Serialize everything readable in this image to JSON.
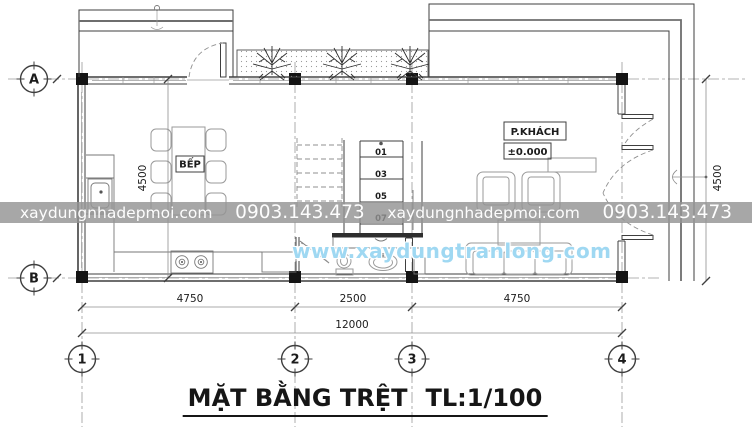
{
  "title": {
    "name": "MẶT BẰNG TRỆT",
    "scale": "TL:1/100"
  },
  "watermarks": {
    "band": {
      "site1": "xaydungnhadepmoi.com",
      "phone1": "0903.143.473",
      "site2": "xaydungnhadepmoi.com",
      "phone2": "0903.143.473"
    },
    "center": "www.xaydungtranlong.com"
  },
  "axes": {
    "a": "A",
    "b": "B",
    "c1": "1",
    "c2": "2",
    "c3": "3",
    "c4": "4"
  },
  "dims": {
    "left_height": "4500",
    "right_height": "4500",
    "span_1_2": "4750",
    "span_2_3": "2500",
    "span_3_4": "4750",
    "total": "12000"
  },
  "rooms": {
    "kitchen": "BẾP",
    "living": "P.KHÁCH",
    "living_level": "±0.000"
  },
  "stairs": {
    "steps": [
      "01",
      "03",
      "05",
      "07"
    ]
  },
  "colors": {
    "line": "#3f3f3f",
    "watermark_band_bg": "#949494",
    "watermark_blue": "#9fd8f2",
    "paper": "#ffffff"
  }
}
